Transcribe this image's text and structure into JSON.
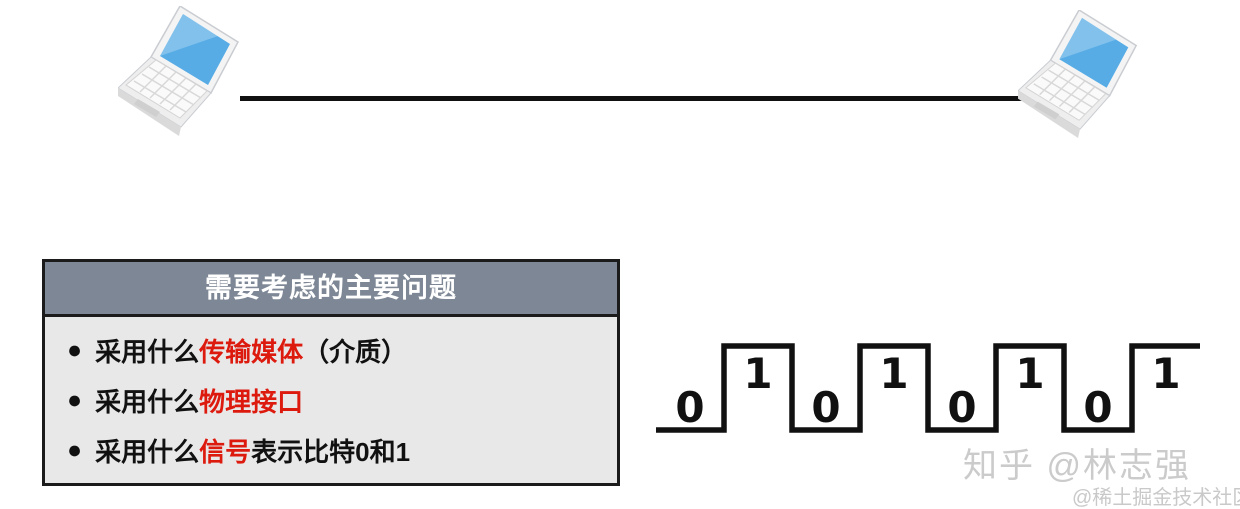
{
  "colors": {
    "accent_red": "#dd1a0e",
    "box_header_bg": "#7d8795",
    "box_body_bg": "#e8e8e8",
    "box_border": "#1b1b1b",
    "line_black": "#111111",
    "watermark_gray": "#cbcbcb",
    "laptop_screen_blue": "#57ace6"
  },
  "topology": {
    "left_icon": "laptop-icon",
    "right_icon": "laptop-icon",
    "link": "point-to-point-cable"
  },
  "issues_box": {
    "title": "需要考虑的主要问题",
    "bullet_glyph": "●",
    "items": [
      {
        "segments": [
          {
            "text": "采用什么",
            "red": false
          },
          {
            "text": "传输媒体",
            "red": true
          },
          {
            "text": "（介质）",
            "red": false
          }
        ]
      },
      {
        "segments": [
          {
            "text": "采用什么",
            "red": false
          },
          {
            "text": "物理接口",
            "red": true
          }
        ]
      },
      {
        "segments": [
          {
            "text": "采用什么",
            "red": false
          },
          {
            "text": "信号",
            "red": true
          },
          {
            "text": "表示比特0和1",
            "red": false
          }
        ]
      }
    ]
  },
  "waveform": {
    "bits": [
      "0",
      "1",
      "0",
      "1",
      "0",
      "1",
      "0",
      "1"
    ],
    "low_label": "0",
    "high_label": "1"
  },
  "watermark": {
    "line1": "知乎 @林志强",
    "line2": "@稀土掘金技术社区"
  }
}
